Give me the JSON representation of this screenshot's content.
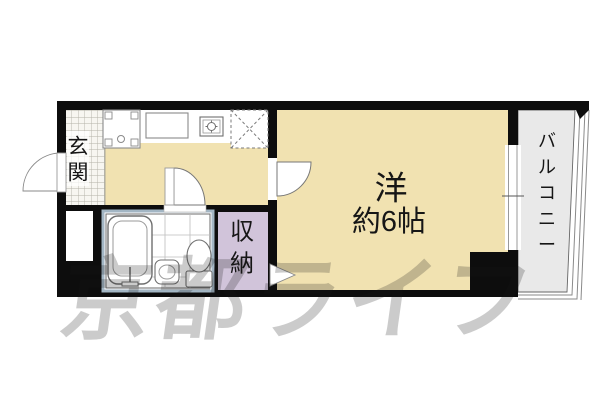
{
  "floorplan": {
    "type": "japanese-apartment-madori",
    "labels": {
      "entrance": [
        "玄",
        "関"
      ],
      "room_name": "洋",
      "room_size": "約6帖",
      "storage": [
        "収",
        "納"
      ],
      "balcony": [
        "バ",
        "ル",
        "コ",
        "ニ",
        "ー"
      ],
      "watermark": "京都ライフ"
    },
    "colors": {
      "floor": "#f1e2b1",
      "storage": "#d1c4da",
      "balcony": "#e9e9e9",
      "wall": "#0d0d0d",
      "genkan_bg": "#f7f6f1",
      "watermark": "#5f5f5f"
    },
    "fixtures": [
      "entrance-door",
      "washing-machine-pan",
      "kitchen-counter",
      "gas-stove",
      "refrigerator-space",
      "room-door",
      "bathroom-door",
      "bathtub",
      "washbasin",
      "toilet",
      "tile-grid",
      "meter-box",
      "window",
      "storage-door-marker",
      "balcony-railing"
    ]
  }
}
